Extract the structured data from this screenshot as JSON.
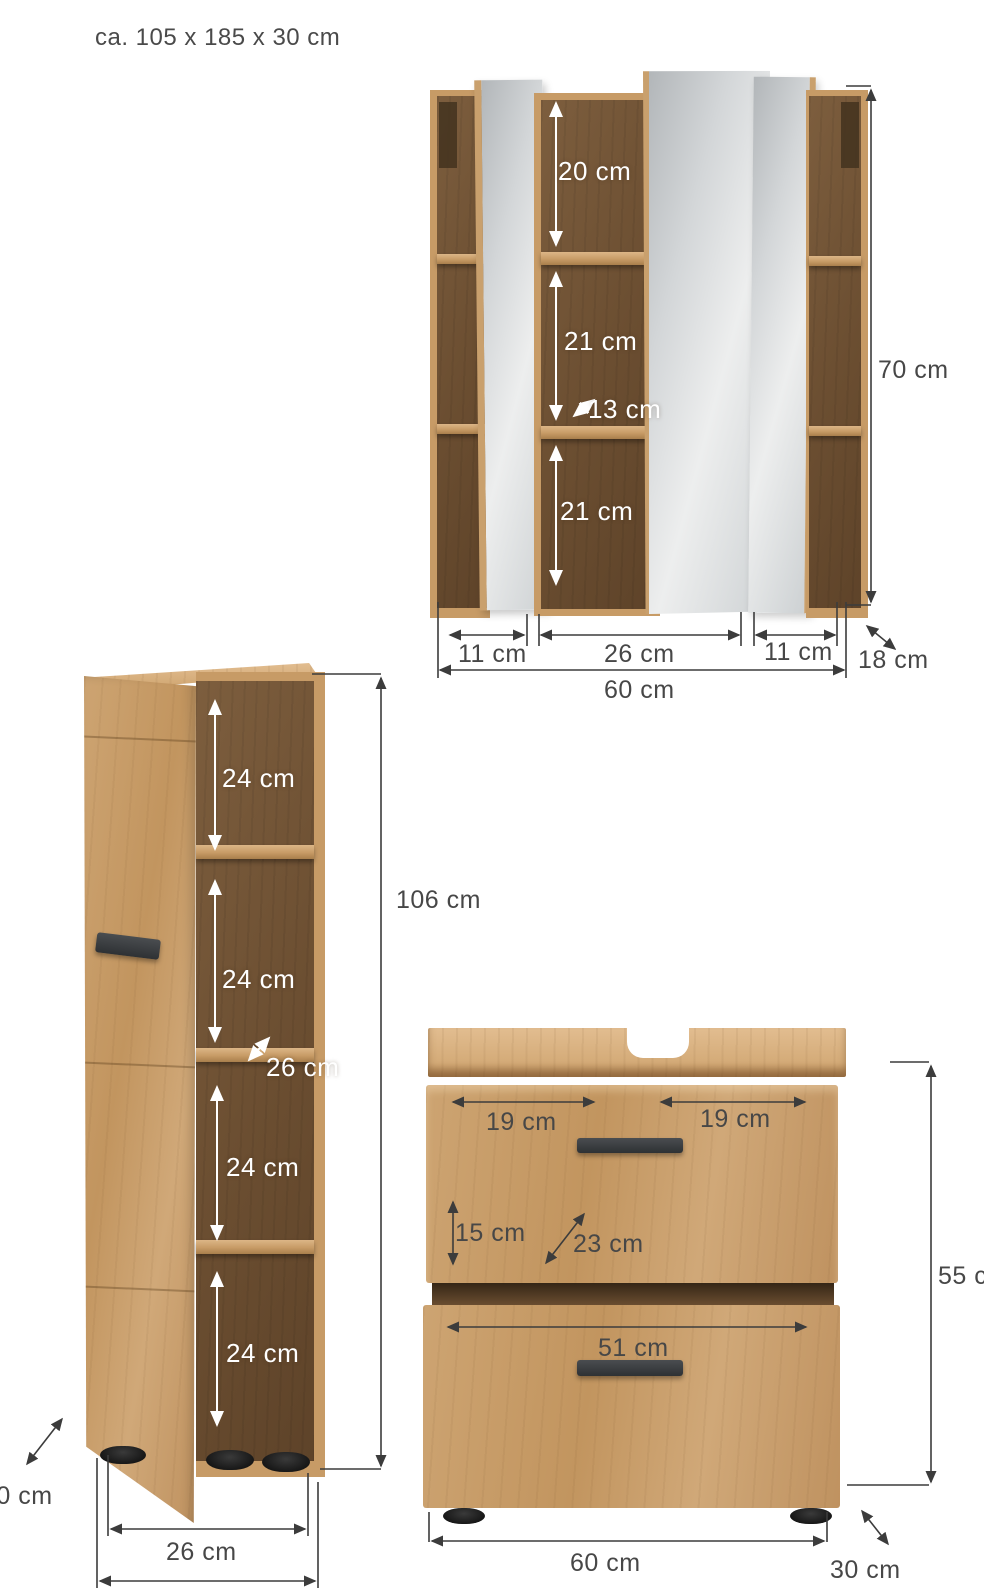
{
  "header": {
    "overall_dimensions": "ca. 105 x 185 x 30 cm"
  },
  "mirror_cabinet": {
    "compartment_top_height": "20 cm",
    "compartment_middle_height": "21 cm",
    "interior_depth": "13 cm",
    "compartment_bottom_height": "21 cm",
    "height": "70 cm",
    "section_left_width": "11 cm",
    "section_center_width": "26 cm",
    "section_right_width": "11 cm",
    "depth": "18 cm",
    "width": "60 cm"
  },
  "tall_cabinet": {
    "compartment_1_height": "24 cm",
    "compartment_2_height": "24 cm",
    "interior_width": "26 cm",
    "compartment_3_height": "24 cm",
    "compartment_4_height": "24 cm",
    "height": "106 cm",
    "width": "26 cm",
    "depth": "30 cm"
  },
  "vanity": {
    "top_left_width": "19 cm",
    "top_right_width": "19 cm",
    "drawer_height": "15 cm",
    "interior_depth": "23 cm",
    "drawer_width": "51 cm",
    "height": "55 cm",
    "width": "60 cm",
    "depth": "30 cm"
  },
  "colors": {
    "oak": "#c79b66",
    "oak_light": "#e2bd90",
    "interior_dark": "#6b4e31",
    "mirror_gray": "#d3d6d8",
    "dimension_line": "#3c3c3c",
    "dimension_text": "#474747",
    "handle_dark": "#3a3d40"
  }
}
